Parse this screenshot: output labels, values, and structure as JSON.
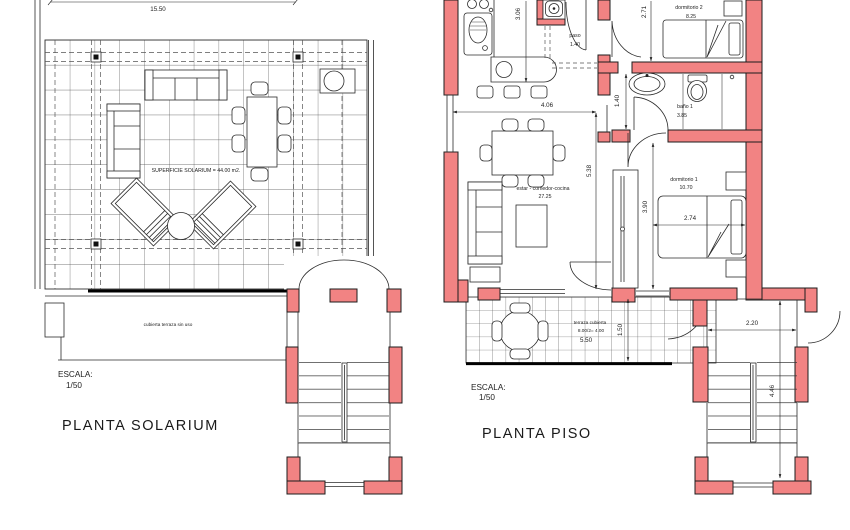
{
  "drawing": {
    "colors": {
      "wall_fill": "#f28383",
      "line_color": "#2b2b2b"
    },
    "solarium": {
      "title": "PLANTA SOLARIUM",
      "scale_label": "ESCALA:",
      "scale_value": "1/50",
      "dim_width": "15.50",
      "area_label": "SUPERFICIE SOLARIUM = 44.00 m2.",
      "terrace_note": "cubierta terraza sin uso"
    },
    "piso": {
      "title": "PLANTA PISO",
      "scale_label": "ESCALA:",
      "scale_value": "1/50",
      "rooms": {
        "paso": {
          "name": "paso",
          "dim": "1.40"
        },
        "dormitorio2": {
          "name": "dormitorio 2",
          "area": "8.25"
        },
        "bano1": {
          "name": "baño 1",
          "area": "3.85"
        },
        "estar": {
          "name": "estar - comedor-cocina",
          "area": "27.25"
        },
        "dormitorio1": {
          "name": "dormitorio 1",
          "area": "10.70"
        },
        "terraza": {
          "name": "terraza cubierta",
          "calc": "8.00/2= 4.00",
          "dim": "5.50"
        }
      },
      "dims": {
        "d306": "3.06",
        "d271": "2.71",
        "d140": "1.40",
        "d406": "4.06",
        "d538": "5.38",
        "d274": "2.74",
        "d390": "3.90",
        "d150": "1.50",
        "d220": "2.20",
        "d446": "4.46"
      }
    }
  }
}
